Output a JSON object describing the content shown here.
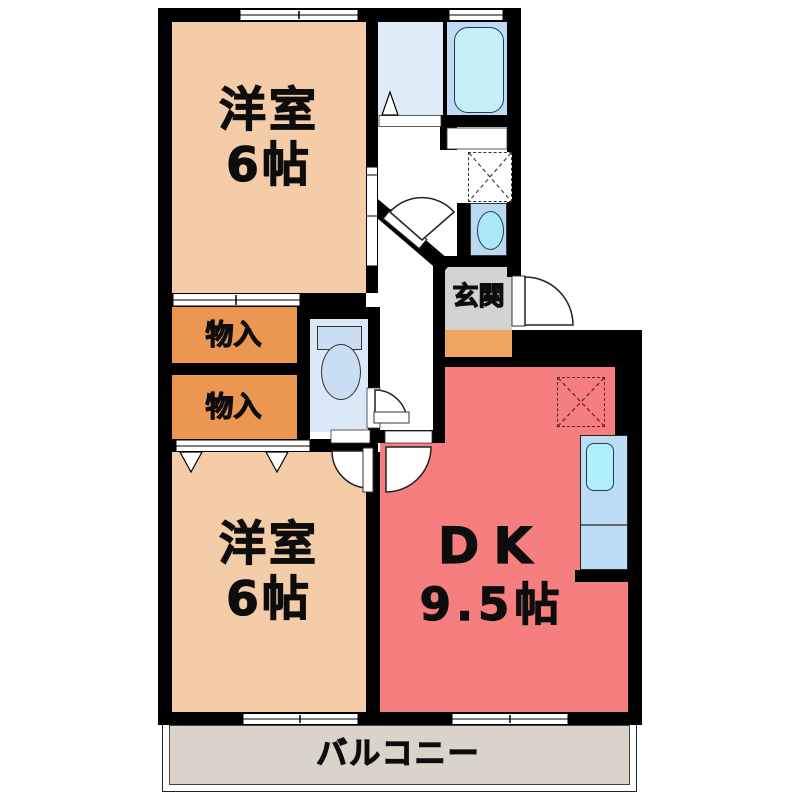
{
  "plan": {
    "type": "apartment floor plan (2DK)",
    "rooms": {
      "bedroom_top": {
        "name": "洋室",
        "size": "6帖"
      },
      "bedroom_bottom": {
        "name": "洋室",
        "size": "6帖"
      },
      "dining_kitchen": {
        "name": "DK",
        "size": "9.5帖"
      },
      "closet_upper": {
        "label": "物入"
      },
      "closet_lower": {
        "label": "物入"
      },
      "entrance": {
        "label": "玄関"
      },
      "balcony": {
        "label": "バルコニー"
      }
    },
    "fixtures": [
      "bathtub",
      "washbasin",
      "washing-machine-space",
      "toilet",
      "kitchen-sink-counter",
      "refrigerator-space",
      "folding-door",
      "entrance-door",
      "room-doors",
      "sliding-windows",
      "closet-doors"
    ],
    "colors": {
      "wall": "#000000",
      "bedroom": "#F4CDA8",
      "closet": "#EB9751",
      "dk": "#F77E7E",
      "genkan_gray": "#D3D3D3",
      "genkan_step_orange": "#EFA55F",
      "balcony": "#DAD3CA",
      "bathroom_floor": "#C0DAF3",
      "washroom_floor": "#E0EBF8",
      "toilet_floor": "#DBE8F7",
      "fixture_blue": "#BBD8F1",
      "water_cyan": "#C6F0F8"
    }
  }
}
